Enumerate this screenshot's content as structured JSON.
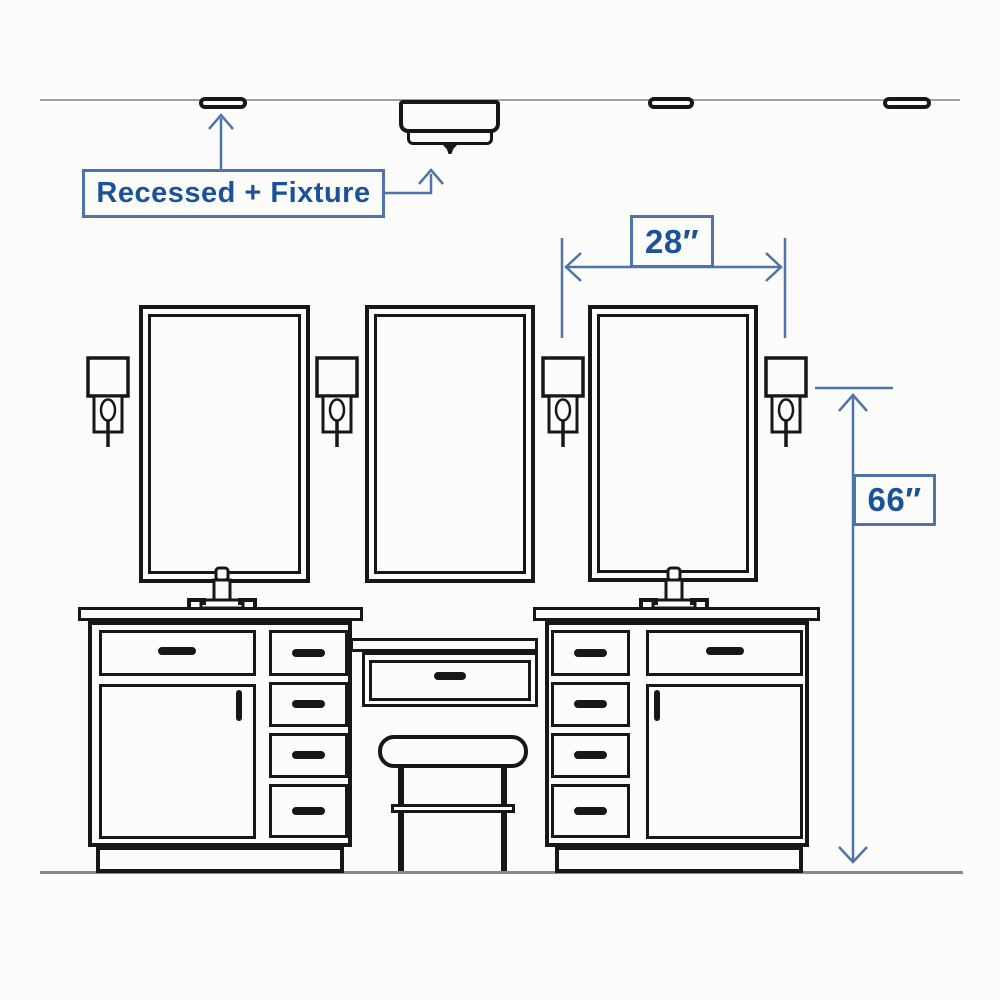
{
  "canvas": {
    "background": "#fcfcfa"
  },
  "colors": {
    "sketch": "#171717",
    "dimension_blue": "#4e74a8",
    "label_text_blue": "#1b5299",
    "ceiling_floor_gray": "#a3a19c",
    "floor_gray": "#8b8984"
  },
  "annotations": {
    "ceiling_label": "Recessed + Fixture",
    "spacing_label": "28″",
    "height_label": "66″"
  },
  "scene": {
    "recessed_light_count": 3,
    "surface_fixture_count": 1,
    "mirror_count": 3,
    "sconce_count": 4,
    "vanity_cabinet_count": 2,
    "stool_count": 1
  }
}
